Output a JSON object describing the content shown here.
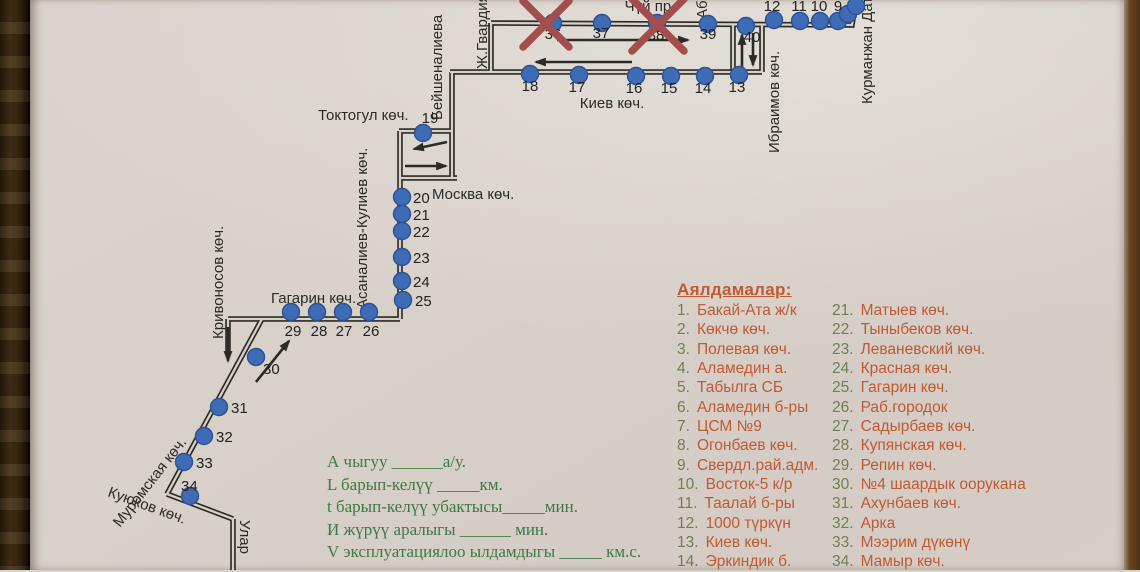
{
  "colors": {
    "paper": "#d8d1ca",
    "ink": "#2c2a26",
    "stop_blue": "#3e6bb5",
    "stop_blue_edge": "#2e5190",
    "red_x": "#a34d4d",
    "legend_orange": "#c05a32",
    "legend_number_green": "#6f7f52",
    "worksheet_green": "#3d7a45",
    "wood_left": "#3f2d14",
    "wood_right": "#5e3d1d"
  },
  "map": {
    "streets": [
      {
        "name": "chui-ave-label",
        "text": "Чүй пр.",
        "x": 650,
        "y": 11,
        "rot": 0,
        "anchor": "middle"
      },
      {
        "name": "kiev-st-label",
        "text": "Киев көч.",
        "x": 612,
        "y": 108,
        "rot": 0,
        "anchor": "middle"
      },
      {
        "name": "toktogul-st-label",
        "text": "Токтогул көч.",
        "x": 318,
        "y": 120,
        "rot": 0,
        "anchor": "start"
      },
      {
        "name": "moskva-st-label",
        "text": "Москва көч.",
        "x": 432,
        "y": 199,
        "rot": 0,
        "anchor": "start"
      },
      {
        "name": "gagarin-st-label",
        "text": "Гагарин көч.",
        "x": 271,
        "y": 303,
        "rot": 0,
        "anchor": "start"
      },
      {
        "name": "beishenalieva-st-label",
        "text": "Бейшеналиева",
        "x": 442,
        "y": 120,
        "rot": -90,
        "anchor": "start"
      },
      {
        "name": "zh-gvardia-st-label",
        "text": "Ж.Гвардия",
        "x": 487,
        "y": 69,
        "rot": -90,
        "anchor": "start"
      },
      {
        "name": "ab-st-label",
        "text": "Аб",
        "x": 707,
        "y": 19,
        "rot": -90,
        "anchor": "start"
      },
      {
        "name": "ibraimov-st-label",
        "text": "Ибраимов көч.",
        "x": 779,
        "y": 153,
        "rot": -90,
        "anchor": "start"
      },
      {
        "name": "kurmanzhan-datka-st-label",
        "text": "Курманжан Датка",
        "x": 872,
        "y": 104,
        "rot": -90,
        "anchor": "start"
      },
      {
        "name": "asanaliev-kuliev-st-label",
        "text": "Асаналиев-Кулиев көч.",
        "x": 367,
        "y": 309,
        "rot": -90,
        "anchor": "start"
      },
      {
        "name": "krivonosov-st-label",
        "text": "Кривоносов көч.",
        "x": 223,
        "y": 339,
        "rot": -90,
        "anchor": "start"
      },
      {
        "name": "muromskaya-st-label",
        "text": "Муромская көч.",
        "x": 120,
        "y": 528,
        "rot": -52,
        "anchor": "start"
      },
      {
        "name": "kuyukov-st-label",
        "text": "Куюков көч.",
        "x": 107,
        "y": 496,
        "rot": 20,
        "anchor": "start"
      },
      {
        "name": "ular-st-label",
        "text": "Улар",
        "x": 240,
        "y": 520,
        "rot": 90,
        "anchor": "start"
      }
    ],
    "segments": [
      {
        "name": "chui",
        "points": "491,23 852,25 856,0"
      },
      {
        "name": "zh-gvardia",
        "points": "491,23 491,72"
      },
      {
        "name": "kiev",
        "points": "450,72 762,72"
      },
      {
        "name": "beishenalieva",
        "points": "452,72 452,178"
      },
      {
        "name": "toktogul",
        "points": "399,131 452,131"
      },
      {
        "name": "moskva",
        "points": "399,178 457,178"
      },
      {
        "name": "asanaliev",
        "points": "400,131 400,319"
      },
      {
        "name": "gagarin",
        "points": "400,319 228,319"
      },
      {
        "name": "krivonosov-spur",
        "points": "228,319 228,354"
      },
      {
        "name": "muromskaya",
        "points": "262,319 167,494"
      },
      {
        "name": "kuyukov",
        "points": "167,494 233,519"
      },
      {
        "name": "ular",
        "points": "233,519 233,570"
      },
      {
        "name": "ibraimov-west",
        "points": "733,24 733,72"
      },
      {
        "name": "ibraimov-east",
        "points": "762,25 762,72"
      }
    ],
    "arrows": [
      {
        "name": "arrow-east-chui",
        "x1": 557,
        "y1": 40,
        "x2": 688,
        "y2": 40
      },
      {
        "name": "arrow-west-kiev",
        "x1": 632,
        "y1": 62,
        "x2": 536,
        "y2": 62
      },
      {
        "name": "arrow-up-ibraimov",
        "x1": 742,
        "y1": 67,
        "x2": 742,
        "y2": 35
      },
      {
        "name": "arrow-down-ibraimov",
        "x1": 753,
        "y1": 33,
        "x2": 753,
        "y2": 65
      },
      {
        "name": "arrow-left-loop",
        "x1": 447,
        "y1": 142,
        "x2": 414,
        "y2": 149
      },
      {
        "name": "arrow-right-loop",
        "x1": 405,
        "y1": 166,
        "x2": 446,
        "y2": 166
      },
      {
        "name": "arrow-northeast-30",
        "x1": 256,
        "y1": 382,
        "x2": 289,
        "y2": 341
      },
      {
        "name": "arrow-down-krivonosov",
        "x1": 228,
        "y1": 327,
        "x2": 228,
        "y2": 361
      }
    ],
    "stops": [
      {
        "n": "9",
        "x": 838,
        "y": 21,
        "lx": 838,
        "ly": 11,
        "la": "middle"
      },
      {
        "n": "10",
        "x": 820,
        "y": 21,
        "lx": 819,
        "ly": 11,
        "la": "middle"
      },
      {
        "n": "11",
        "x": 800,
        "y": 21,
        "lx": 799,
        "ly": 11,
        "la": "middle"
      },
      {
        "n": "12",
        "x": 774,
        "y": 20,
        "lx": 772,
        "ly": 11,
        "la": "middle"
      },
      {
        "n": "13",
        "x": 739,
        "y": 75,
        "lx": 737,
        "ly": 92,
        "la": "middle"
      },
      {
        "n": "14",
        "x": 705,
        "y": 76,
        "lx": 703,
        "ly": 93,
        "la": "middle"
      },
      {
        "n": "15",
        "x": 671,
        "y": 76,
        "lx": 669,
        "ly": 93,
        "la": "middle"
      },
      {
        "n": "16",
        "x": 636,
        "y": 76,
        "lx": 634,
        "ly": 93,
        "la": "middle"
      },
      {
        "n": "17",
        "x": 579,
        "y": 75,
        "lx": 577,
        "ly": 92,
        "la": "middle"
      },
      {
        "n": "18",
        "x": 530,
        "y": 74,
        "lx": 530,
        "ly": 91,
        "la": "middle"
      },
      {
        "n": "19",
        "x": 423,
        "y": 133,
        "lx": 430,
        "ly": 123,
        "la": "middle"
      },
      {
        "n": "20",
        "x": 402,
        "y": 197,
        "lx": 413,
        "ly": 203,
        "la": "start"
      },
      {
        "n": "21",
        "x": 402,
        "y": 214,
        "lx": 413,
        "ly": 220,
        "la": "start"
      },
      {
        "n": "22",
        "x": 402,
        "y": 231,
        "lx": 413,
        "ly": 237,
        "la": "start"
      },
      {
        "n": "23",
        "x": 402,
        "y": 257,
        "lx": 413,
        "ly": 263,
        "la": "start"
      },
      {
        "n": "24",
        "x": 402,
        "y": 281,
        "lx": 413,
        "ly": 287,
        "la": "start"
      },
      {
        "n": "25",
        "x": 403,
        "y": 300,
        "lx": 415,
        "ly": 306,
        "la": "start"
      },
      {
        "n": "26",
        "x": 369,
        "y": 312,
        "lx": 371,
        "ly": 336,
        "la": "middle"
      },
      {
        "n": "27",
        "x": 343,
        "y": 312,
        "lx": 344,
        "ly": 336,
        "la": "middle"
      },
      {
        "n": "28",
        "x": 317,
        "y": 312,
        "lx": 319,
        "ly": 336,
        "la": "middle"
      },
      {
        "n": "29",
        "x": 291,
        "y": 312,
        "lx": 293,
        "ly": 336,
        "la": "middle"
      },
      {
        "n": "30",
        "x": 256,
        "y": 357,
        "lx": 263,
        "ly": 374,
        "la": "start"
      },
      {
        "n": "31",
        "x": 219,
        "y": 407,
        "lx": 231,
        "ly": 413,
        "la": "start"
      },
      {
        "n": "32",
        "x": 204,
        "y": 436,
        "lx": 216,
        "ly": 442,
        "la": "start"
      },
      {
        "n": "33",
        "x": 184,
        "y": 462,
        "lx": 196,
        "ly": 468,
        "la": "start"
      },
      {
        "n": "34",
        "x": 190,
        "y": 496,
        "lx": 181,
        "ly": 491,
        "la": "start"
      },
      {
        "n": "36",
        "x": 553,
        "y": 23,
        "lx": 553,
        "ly": 39,
        "la": "middle"
      },
      {
        "n": "37",
        "x": 602,
        "y": 23,
        "lx": 601,
        "ly": 38,
        "la": "middle"
      },
      {
        "n": "38",
        "x": 657,
        "y": 23,
        "lx": 656,
        "ly": 40,
        "la": "middle"
      },
      {
        "n": "39",
        "x": 708,
        "y": 24,
        "lx": 708,
        "ly": 39,
        "la": "middle"
      },
      {
        "n": "40",
        "x": 746,
        "y": 26,
        "lx": 752,
        "ly": 42,
        "la": "middle"
      }
    ],
    "unnumbered_stops": [
      {
        "x": 848,
        "y": 14
      },
      {
        "x": 856,
        "y": 6
      }
    ],
    "cancelled_marks": [
      {
        "x": 546,
        "y": 24,
        "s": 23
      },
      {
        "x": 658,
        "y": 25,
        "s": 26
      }
    ]
  },
  "legend": {
    "title": "Аялдамалар:",
    "col1": [
      {
        "n": "1.",
        "name": "Бакай-Ата ж/к"
      },
      {
        "n": "2.",
        "name": "Көкчө көч."
      },
      {
        "n": "3.",
        "name": "Полевая көч."
      },
      {
        "n": "4.",
        "name": "Аламедин а."
      },
      {
        "n": "5.",
        "name": "Табылга СБ"
      },
      {
        "n": "6.",
        "name": "Аламедин б-ры"
      },
      {
        "n": "7.",
        "name": "ЦСМ №9"
      },
      {
        "n": "8.",
        "name": "Огонбаев көч."
      },
      {
        "n": "9.",
        "name": "Свердл.рай.адм."
      },
      {
        "n": "10.",
        "name": "Восток-5 к/р"
      },
      {
        "n": "11.",
        "name": "Таалай б-ры"
      },
      {
        "n": "12.",
        "name": "1000 түркүн"
      },
      {
        "n": "13.",
        "name": "Киев көч."
      },
      {
        "n": "14.",
        "name": "Эркиндик б."
      }
    ],
    "col2": [
      {
        "n": "21.",
        "name": "Матыев көч."
      },
      {
        "n": "22.",
        "name": "Тыныбеков көч."
      },
      {
        "n": "23.",
        "name": "Леваневский көч."
      },
      {
        "n": "24.",
        "name": "Красная көч."
      },
      {
        "n": "25.",
        "name": "Гагарин көч."
      },
      {
        "n": "26.",
        "name": "Раб.городок"
      },
      {
        "n": "27.",
        "name": "Садырбаев көч."
      },
      {
        "n": "28.",
        "name": "Купянская көч."
      },
      {
        "n": "29.",
        "name": "Репин көч."
      },
      {
        "n": "30.",
        "name": "№4 шаардык оорукана"
      },
      {
        "n": "31.",
        "name": "Ахунбаев көч."
      },
      {
        "n": "32.",
        "name": "Арка"
      },
      {
        "n": "33.",
        "name": "Мээрим дүкөнү"
      },
      {
        "n": "34.",
        "name": "Мамыр көч."
      }
    ]
  },
  "worksheet": {
    "lines": [
      "А чыгуу   ______а/у.",
      "L барып-келүү  _____км.",
      "t барып-келүү убактысы_____мин.",
      "И жүрүү аралыгы ______      мин.",
      "V эксплуатациялоо ылдамдыгы _____ км.с."
    ]
  }
}
